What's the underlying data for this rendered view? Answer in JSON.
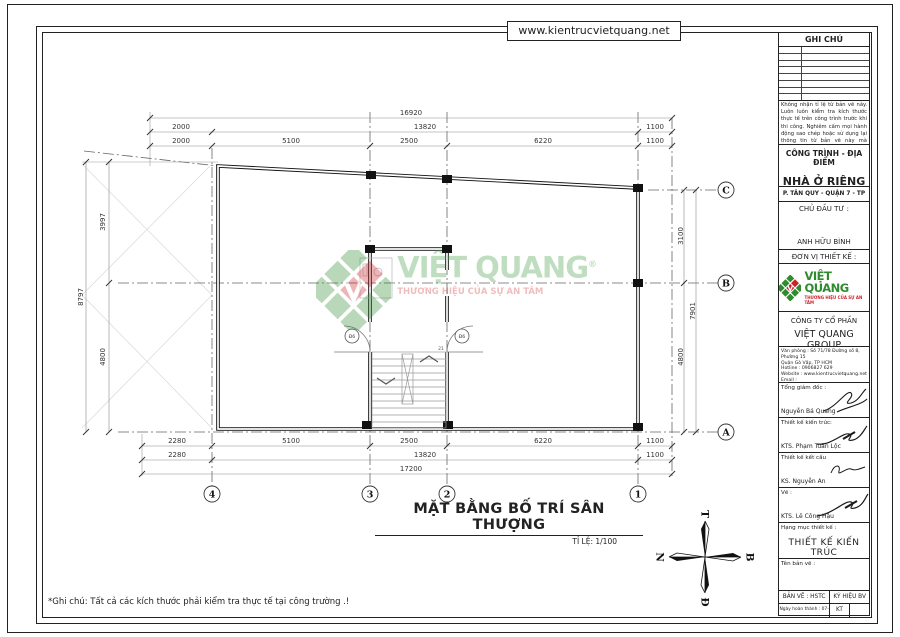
{
  "page": {
    "url": "www.kientrucvietquang.net",
    "footer_note": "*Ghi chú: Tất cả các kích thước phải kiểm tra thực tế tại công trường .!"
  },
  "title_block": {
    "ghi_chu": "GHI CHÚ",
    "notes": [
      "Không nhận tỉ lệ từ bản vẽ này.",
      "Luôn luôn kiểm tra kích thước thực tế trên công trình trước khi thi công.",
      "Nghiêm cấm mọi hành động sao chép hoặc sử dụng lại thông tin từ bản vẽ này mà không được sự cho phép của Công ty CP Kiến Trúc Việt Quang"
    ],
    "project_label": "CÔNG TRÌNH - ĐỊA ĐIỂM",
    "project_name": "NHÀ Ở RIÊNG LẺ",
    "project_address": "P. TÂN QUY - QUẬN 7 - TP HCM",
    "investor_label": "CHỦ ĐẦU TƯ :",
    "investor_name": "ANH HỮU BÌNH",
    "designer_label": "ĐƠN VỊ THIẾT KẾ :",
    "brand": {
      "name": "VIỆT QUANG",
      "reg": "®",
      "tagline": "THƯƠNG HIỆU CỦA SỰ AN TÂM",
      "green": "#3f9b3f",
      "red": "#cc2229"
    },
    "company_line1": "CÔNG TY CỔ PHẦN",
    "company_line2": "VIỆT QUANG GROUP",
    "contact_lines": [
      "Văn phòng : Số 71/78 Đường số 8, Phường 15",
      "Quận Gò Vấp, TP HCM",
      "Hotline : 0906827 629",
      "Website : www.kientrucvietquang.net",
      "Email : kientrucvietquang2000@gmail.com",
      "MST : 0313420514"
    ],
    "signatures": [
      {
        "role": "Tổng giám đốc :",
        "name": "Nguyễn Bá Quang"
      },
      {
        "role": "Thiết kế kiến trúc:",
        "name": "KTS. Phạm Tuấn Lộc"
      },
      {
        "role": "Thiết kế kết cấu",
        "name": "KS. Nguyễn An"
      },
      {
        "role": "Vẽ :",
        "name": "KTS. Lê Công Hậu"
      }
    ],
    "category_label": "Hạng mục thiết kế :",
    "category_value": "THIẾT KẾ KIẾN TRÚC",
    "sheet_name_label": "Tên bản vẽ :",
    "sheet_type_label": "BẢN VẼ : HSTC",
    "sheet_symbol_label": "KÝ HIỆU BV",
    "date_label": "Ngày hoàn thành : 07-2024",
    "sheet_code": "KT"
  },
  "drawing": {
    "title": "MẶT BẰNG BỐ TRÍ SÂN THƯỢNG",
    "scale": "TỈ LỆ: 1/100",
    "dimensions": [
      {
        "x": 411,
        "y": 115,
        "t": "16920"
      },
      {
        "x": 181,
        "y": 129,
        "t": "2000"
      },
      {
        "x": 425,
        "y": 129,
        "t": "13820"
      },
      {
        "x": 655,
        "y": 129,
        "t": "1100"
      },
      {
        "x": 181,
        "y": 143,
        "t": "2000"
      },
      {
        "x": 291,
        "y": 143,
        "t": "5100"
      },
      {
        "x": 409,
        "y": 143,
        "t": "2500"
      },
      {
        "x": 543,
        "y": 143,
        "t": "6220"
      },
      {
        "x": 655,
        "y": 143,
        "t": "1100"
      },
      {
        "x": 177,
        "y": 443,
        "t": "2280"
      },
      {
        "x": 291,
        "y": 443,
        "t": "5100"
      },
      {
        "x": 409,
        "y": 443,
        "t": "2500"
      },
      {
        "x": 543,
        "y": 443,
        "t": "6220"
      },
      {
        "x": 655,
        "y": 443,
        "t": "1100"
      },
      {
        "x": 177,
        "y": 457,
        "t": "2280"
      },
      {
        "x": 425,
        "y": 457,
        "t": "13820"
      },
      {
        "x": 655,
        "y": 457,
        "t": "1100"
      },
      {
        "x": 411,
        "y": 471,
        "t": "17200"
      },
      {
        "x": 105,
        "y": 222,
        "t": "3997",
        "r": 1
      },
      {
        "x": 83,
        "y": 297,
        "t": "8797",
        "r": 1
      },
      {
        "x": 105,
        "y": 357,
        "t": "4800",
        "r": 1
      },
      {
        "x": 683,
        "y": 236,
        "t": "3100",
        "r": 1
      },
      {
        "x": 695,
        "y": 311,
        "t": "7901",
        "r": 1
      },
      {
        "x": 683,
        "y": 357,
        "t": "4800",
        "r": 1
      }
    ],
    "grid_cols": [
      {
        "x": 212,
        "label": "4"
      },
      {
        "x": 370,
        "label": "3"
      },
      {
        "x": 447,
        "label": "2"
      },
      {
        "x": 638,
        "label": "1"
      }
    ],
    "grid_rows": [
      {
        "y": 190,
        "label": "C"
      },
      {
        "y": 283,
        "label": "B"
      },
      {
        "y": 432,
        "label": "A"
      }
    ],
    "doors": [
      {
        "x": 352,
        "y": 336,
        "label": "Đ6"
      },
      {
        "x": 462,
        "y": 336,
        "label": "Đ6"
      }
    ],
    "stair_label": {
      "x": 441,
      "y": 350,
      "t": "21"
    },
    "compass": {
      "top": "T",
      "right": "B",
      "bottom": "Đ",
      "left": "N"
    }
  }
}
